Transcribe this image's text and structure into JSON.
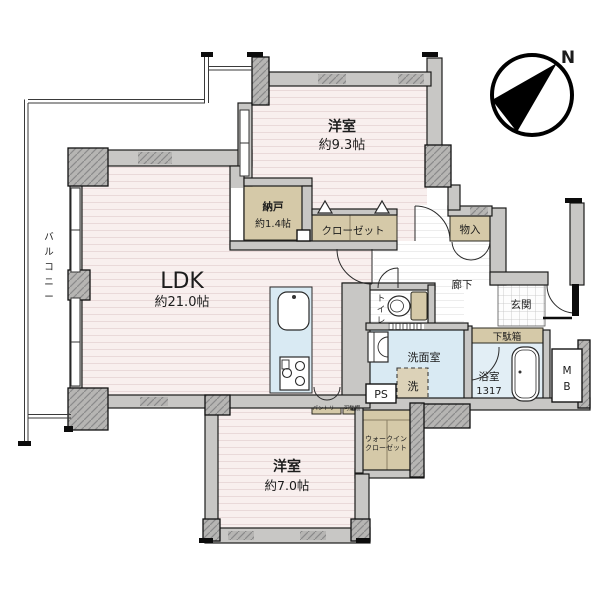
{
  "compass": {
    "north_label": "N"
  },
  "balcony": {
    "label": "バルコニー",
    "chars": [
      "バ",
      "ル",
      "コ",
      "ニ",
      "ー"
    ]
  },
  "rooms": {
    "western1": {
      "name": "洋室",
      "size": "約9.3帖"
    },
    "ldk": {
      "name": "LDK",
      "size": "約21.0帖"
    },
    "western2": {
      "name": "洋室",
      "size": "約7.0帖"
    },
    "storage": {
      "name": "納戸",
      "size": "約1.4帖"
    },
    "closet": {
      "name": "クローゼット"
    },
    "hall_closet": {
      "name": "物入"
    },
    "hallway": {
      "name": "廊下"
    },
    "entrance": {
      "name": "玄関"
    },
    "shoe_cabinet": {
      "name": "下駄箱"
    },
    "washroom": {
      "name": "洗面室"
    },
    "washer": {
      "name": "洗"
    },
    "toilet": {
      "label": "トイレ",
      "chars": [
        "ト",
        "イ",
        "レ"
      ]
    },
    "bathroom": {
      "name": "浴室",
      "size": "1317"
    },
    "meter_box": {
      "label": "MB",
      "chars": [
        "M",
        "B"
      ]
    },
    "pipe_space": {
      "name": "PS"
    },
    "wic": {
      "line1": "ウォークイン",
      "line2": "クローゼット"
    },
    "pantry": {
      "name": "パントリー"
    },
    "shelf": {
      "name": "可動棚"
    }
  },
  "colors": {
    "wall": "#c8c7c5",
    "pillar_hatch": "#b6b5b3",
    "floor_pink": "#f8efee",
    "floor_stripe": "#e9d9d9",
    "storage_tan": "#d5c9a8",
    "wet_blue": "#d9eaf3",
    "bath_blue": "#e2eef5",
    "outline": "#1b1b1b"
  }
}
